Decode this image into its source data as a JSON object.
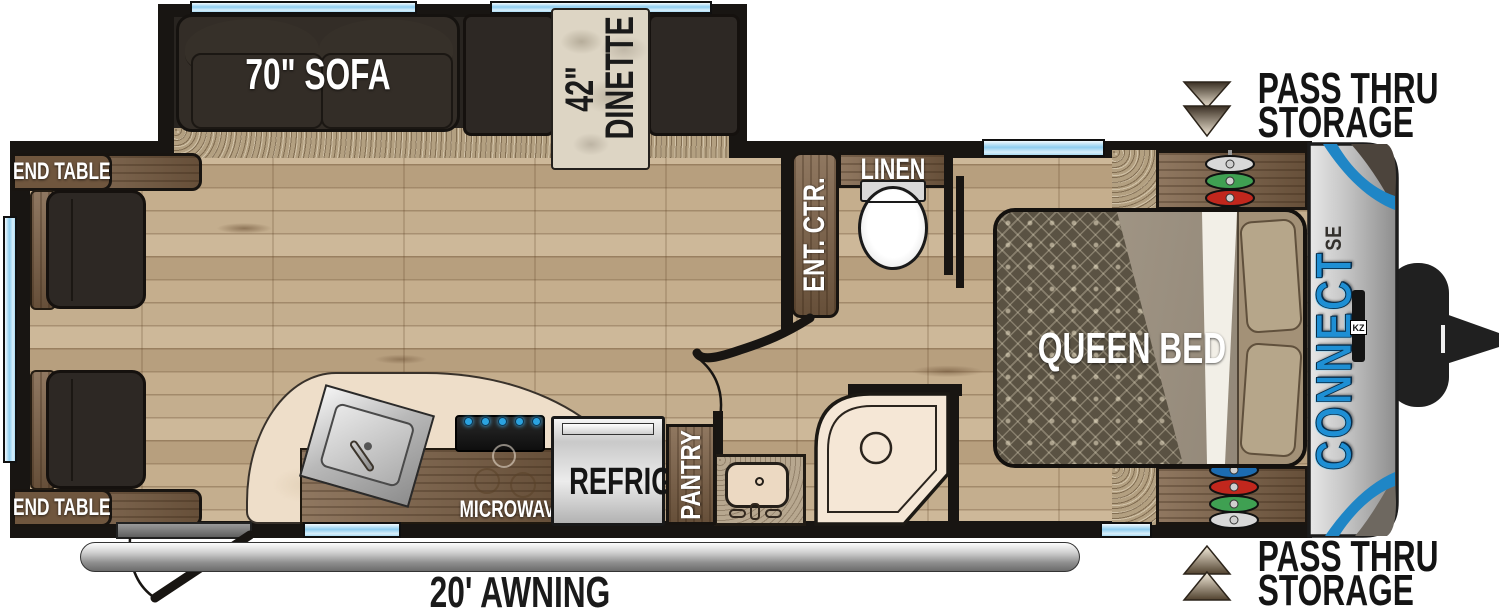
{
  "title": "KZ Connect SE travel trailer floor plan",
  "labels": {
    "sofa": "70\" SOFA",
    "dinette_size": "42\"",
    "dinette_name": "DINETTE",
    "end_table": "END TABLE",
    "ent_ctr": "ENT. CTR.",
    "linen": "LINEN",
    "queen_bed": "QUEEN BED",
    "microwave": "MICROWAVE",
    "refrig": "REFRIG",
    "pantry": "PANTRY",
    "awning": "20' AWNING"
  },
  "passthru": {
    "line1": "PASS THRU",
    "line2": "STORAGE"
  },
  "brand": {
    "name": "CONNECT",
    "trim": "SE",
    "logo": "KZ"
  },
  "colors": {
    "wall": "#181512",
    "wood_floor": "#c4ae8e",
    "cabinet_brown": "#7d6146",
    "cushion_dark": "#2d2824",
    "window_blue": "#8ecdef",
    "brand_blue": "#1e8fd4",
    "cap_silver": "#c2c2c2",
    "disc_green": "#3fa052",
    "disc_red": "#c1271d",
    "disc_blue": "#1c6cb2",
    "label_white": "#ffffff",
    "label_black": "#151515"
  }
}
